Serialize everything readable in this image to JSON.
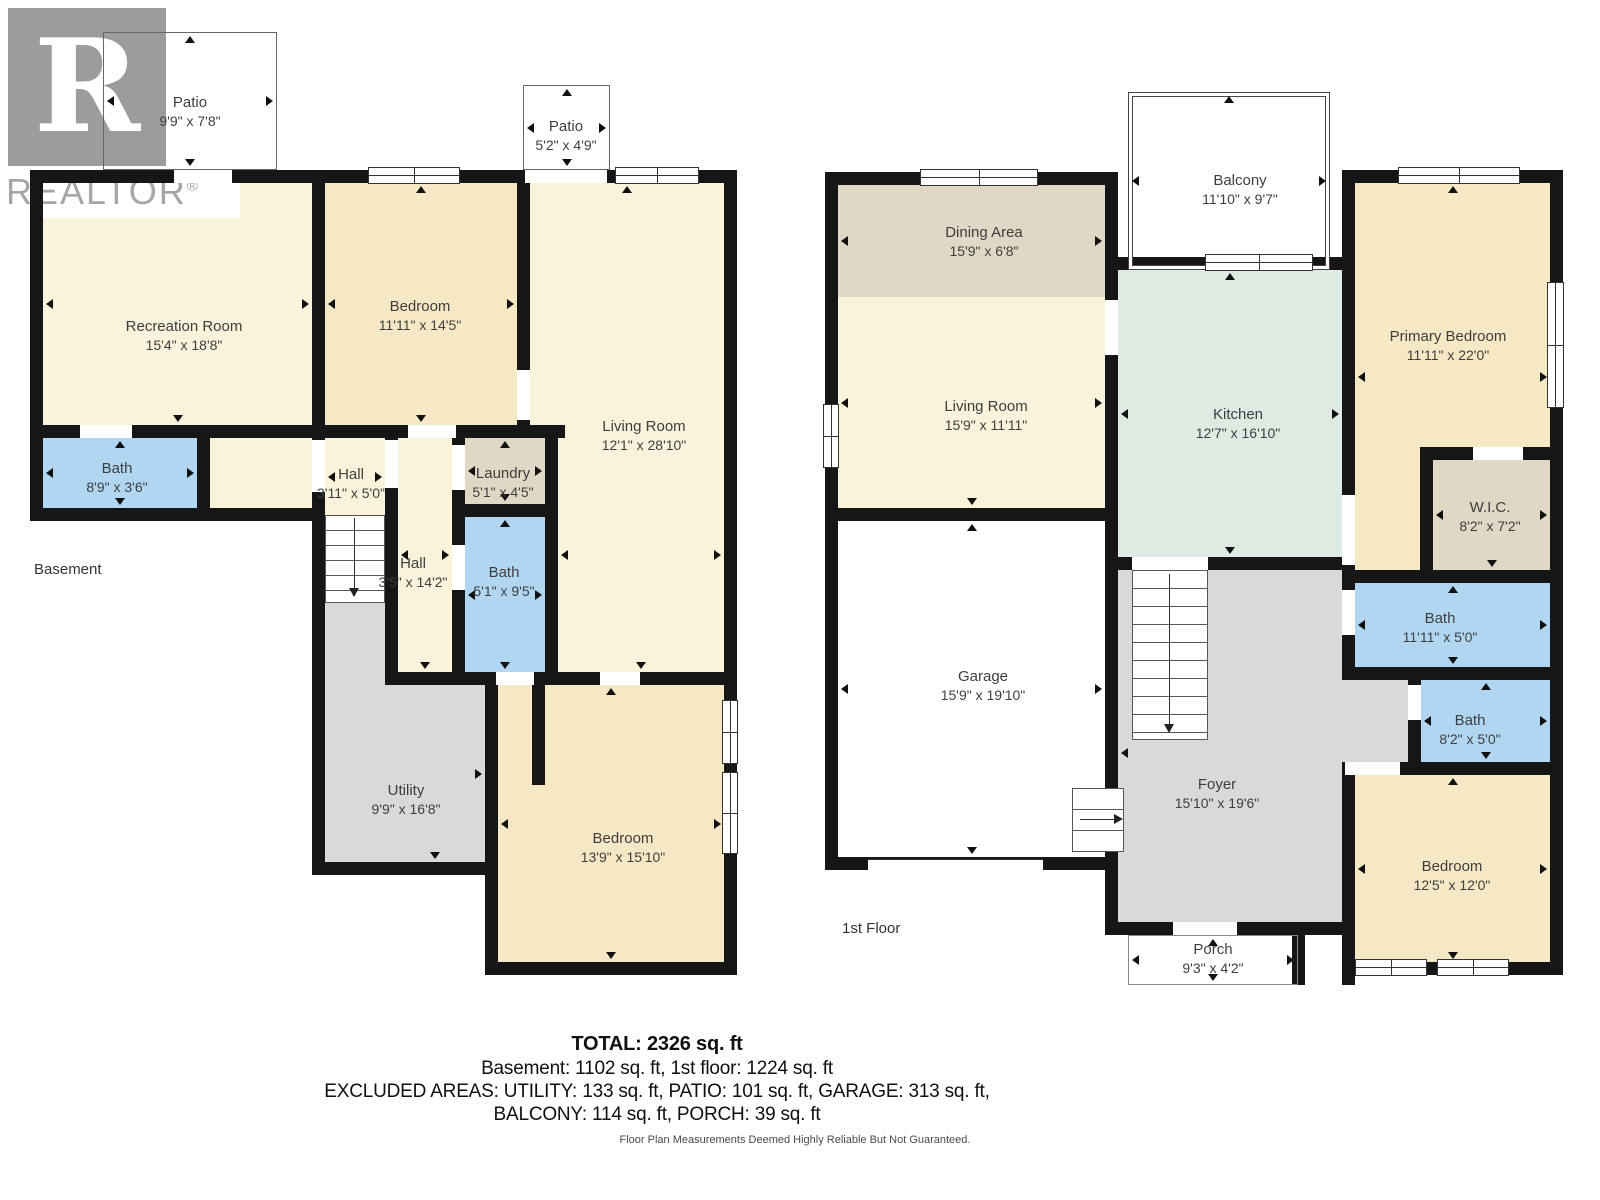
{
  "logo": {
    "letter": "R",
    "brand": "REALTOR",
    "reg": "®"
  },
  "basement": {
    "floor_label": "Basement",
    "rooms": {
      "patio_large": {
        "name": "Patio",
        "dims": "9'9\" x 7'8\""
      },
      "patio_small": {
        "name": "Patio",
        "dims": "5'2\" x 4'9\""
      },
      "recreation": {
        "name": "Recreation Room",
        "dims": "15'4\" x 18'8\""
      },
      "bedroom": {
        "name": "Bedroom",
        "dims": "11'11\" x 14'5\""
      },
      "living": {
        "name": "Living Room",
        "dims": "12'1\" x 28'10\""
      },
      "bath_small": {
        "name": "Bath",
        "dims": "8'9\" x 3'6\""
      },
      "hall_small": {
        "name": "Hall",
        "dims": "3'11\" x 5'0\""
      },
      "hall_long": {
        "name": "Hall",
        "dims": "3'5\" x 14'2\""
      },
      "laundry": {
        "name": "Laundry",
        "dims": "5'1\" x 4'5\""
      },
      "bath_main": {
        "name": "Bath",
        "dims": "5'1\" x 9'5\""
      },
      "utility": {
        "name": "Utility",
        "dims": "9'9\" x 16'8\""
      },
      "bedroom2": {
        "name": "Bedroom",
        "dims": "13'9\" x 15'10\""
      }
    }
  },
  "first_floor": {
    "floor_label": "1st Floor",
    "rooms": {
      "balcony": {
        "name": "Balcony",
        "dims": "11'10\" x 9'7\""
      },
      "dining": {
        "name": "Dining Area",
        "dims": "15'9\" x 6'8\""
      },
      "living": {
        "name": "Living Room",
        "dims": "15'9\" x 11'11\""
      },
      "kitchen": {
        "name": "Kitchen",
        "dims": "12'7\" x 16'10\""
      },
      "primary": {
        "name": "Primary Bedroom",
        "dims": "11'11\" x 22'0\""
      },
      "wic": {
        "name": "W.I.C.",
        "dims": "8'2\" x 7'2\""
      },
      "bath_top": {
        "name": "Bath",
        "dims": "11'11\" x 5'0\""
      },
      "bath_mid": {
        "name": "Bath",
        "dims": "8'2\" x 5'0\""
      },
      "bedroom": {
        "name": "Bedroom",
        "dims": "12'5\" x 12'0\""
      },
      "garage": {
        "name": "Garage",
        "dims": "15'9\" x 19'10\""
      },
      "foyer": {
        "name": "Foyer",
        "dims": "15'10\" x 19'6\""
      },
      "porch": {
        "name": "Porch",
        "dims": "9'3\" x 4'2\""
      }
    }
  },
  "summary": {
    "total": "TOTAL: 2326 sq. ft",
    "floors": "Basement: 1102 sq. ft, 1st floor: 1224 sq. ft",
    "excluded_1": "EXCLUDED AREAS: UTILITY: 133 sq. ft, PATIO: 101 sq. ft, GARAGE: 313 sq. ft,",
    "excluded_2": "BALCONY: 114 sq. ft, PORCH: 39 sq. ft"
  },
  "disclaimer": "Floor Plan Measurements Deemed Highly Reliable But Not Guaranteed.",
  "colors": {
    "room_yellow": "#FAF3DB",
    "room_cream": "#F6E8C5",
    "room_blue": "#B0D6F1",
    "room_tan": "#E0D7C5",
    "room_mint": "#DDEBE2",
    "room_gray": "#D9D9D9",
    "wall": "#161616"
  }
}
